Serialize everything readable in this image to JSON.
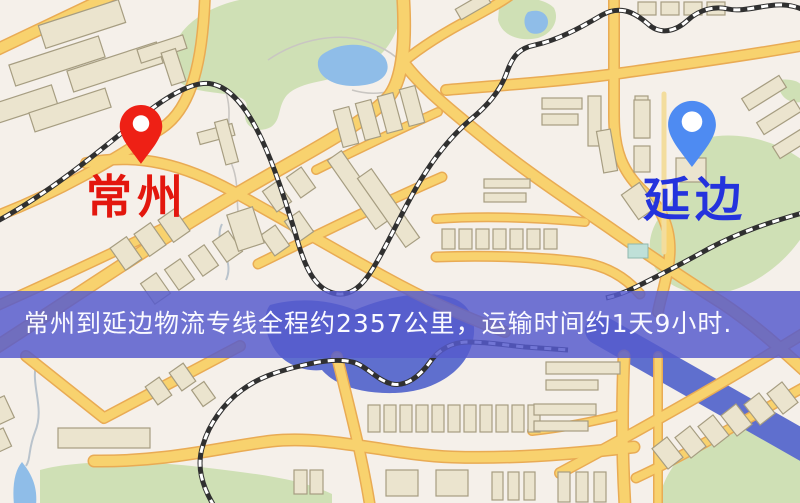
{
  "map": {
    "origin_marker": {
      "label": "常州",
      "color": "#e3170e",
      "pin_color": "#ee2015"
    },
    "destination_marker": {
      "label": "延边",
      "color": "#2433dd",
      "pin_color": "#4e8bf2"
    }
  },
  "banner": {
    "text": "常州到延边物流专线全程约2357公里，运输时间约1天9小时.",
    "background": "rgba(86,90,205,0.84)",
    "text_color": "#fafaff"
  },
  "palette": {
    "background": "#f5f0ea",
    "road_fill": "#f8d26e",
    "road_casing": "#e9ab54",
    "green_area": "#cfe0b5",
    "water": "#8fbde8",
    "river": "#5f6fce",
    "building_fill": "#ebe4ce",
    "building_stroke": "#a69d81",
    "railway": "#303030"
  }
}
